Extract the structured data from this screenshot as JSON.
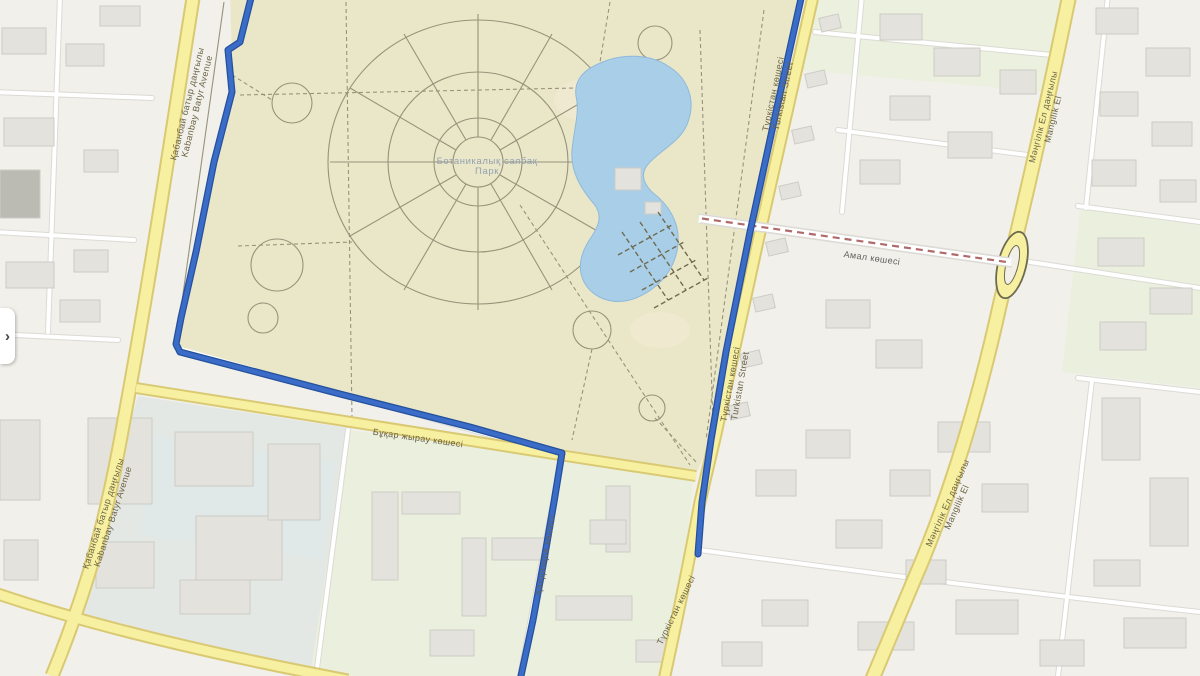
{
  "map": {
    "type": "city-street-map-with-route",
    "park_label": {
      "line1": "Ботаникалық саябақ",
      "line2": "Парк"
    },
    "roads": {
      "kabanbay": {
        "kk": "Қабанбай батыр даңғылы",
        "en": "Kabanbay Batyr Avenue"
      },
      "turkistan": {
        "kk": "Түркістан көшесі",
        "en": "Turkistan Street"
      },
      "mangilik": {
        "kk": "Мәңгілік Ел даңғылы",
        "en": "Mangilik El"
      },
      "amal": {
        "kk": "Амал көшесі"
      },
      "bukhar_zhyrau": {
        "kk": "Бұқар жырау көшесі"
      },
      "kaldayakov": {
        "kk": "Қалдаяқов көшесі"
      },
      "turkistan_south": {
        "kk": "Түркістан көшесі"
      }
    },
    "ui": {
      "panel_toggle_icon": "›"
    },
    "colors": {
      "background": "#f1f0ea",
      "park": "#eae7c9",
      "sand": "#efe9d0",
      "water": "#a9cee8",
      "water_edge": "#8fb9da",
      "road_fill": "#f7f0a0",
      "road_casing": "#d9c973",
      "road_minor": "#ffffff",
      "road_minor_casing": "#dbdad4",
      "route": "#3a6cc8",
      "route_casing": "#24509c",
      "building": "#e3e2dd",
      "building_outline": "#ccccc5",
      "building_dark": "#bbbbb4",
      "block_green": "#ebf0de",
      "block_gray": "#e4e8e5",
      "block_blue": "#dfe8ea",
      "path": "#96937a",
      "path_dark": "#6e6b50",
      "label_road": "#6b6345",
      "label_minor": "#5f5f5f",
      "park_label": "#93a0b2",
      "rail": "#b06a6a",
      "panel": "#ffffff",
      "chevron": "#444444"
    }
  }
}
